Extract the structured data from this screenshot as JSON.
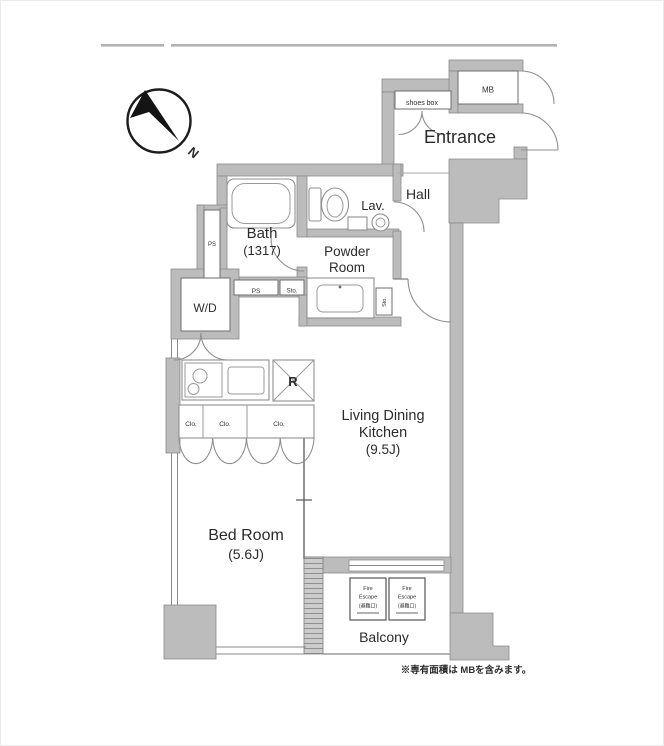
{
  "floorplan": {
    "compass": {
      "north": "N"
    },
    "rooms": {
      "entrance": "Entrance",
      "hall": "Hall",
      "lav": "Lav.",
      "bath": {
        "name": "Bath",
        "size": "(1317)"
      },
      "powder_room": {
        "line1": "Powder",
        "line2": "Room"
      },
      "ldk": {
        "line1": "Living Dining",
        "line2": "Kitchen",
        "size": "(9.5J)"
      },
      "bedroom": {
        "name": "Bed Room",
        "size": "(5.6J)"
      },
      "balcony": "Balcony"
    },
    "fixtures": {
      "mb": "MB",
      "shoes_box": "shoes box",
      "wd": "W/D",
      "ps_duct": "PS",
      "ps_small": "PS",
      "sto_1": "Sto.",
      "sto_2": "Sto.",
      "refrigerator": "R",
      "closets": [
        "Clo.",
        "Clo.",
        "Clo."
      ],
      "fire_escape": {
        "line1": "Fire",
        "line2": "Escape",
        "line3": "(避難口)"
      }
    },
    "footnote": "※専有面積は MBを含みます。"
  }
}
